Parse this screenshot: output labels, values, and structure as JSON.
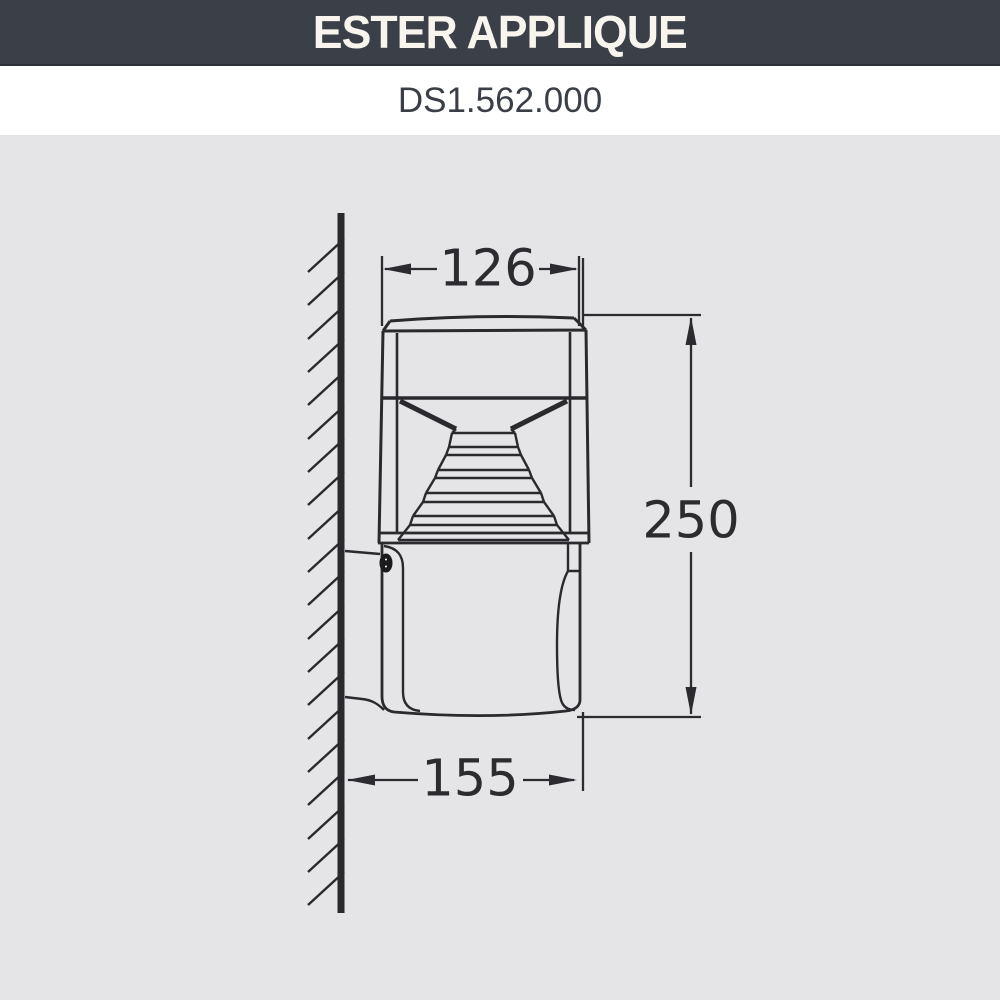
{
  "header": {
    "title": "ESTER APPLIQUE",
    "bg_color": "#3B3F47",
    "text_color": "#F8F4EE",
    "product_code": "DS1.562.000",
    "code_color": "#3A3E46"
  },
  "drawing": {
    "bg_color": "#E5E5E7",
    "line_color": "#29292E",
    "description": "Side-view technical drawing of wall-mounted luminaire fixed to a hatched wall",
    "dimensions": {
      "top_width": "126",
      "overall_height": "250",
      "wall_projection": "155"
    }
  }
}
